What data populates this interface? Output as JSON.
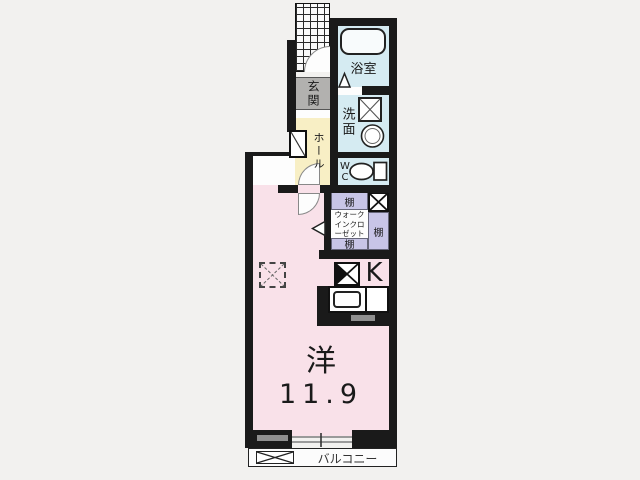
{
  "plan": {
    "type": "apartment-floor-plan",
    "rooms": {
      "entrance": {
        "label": "玄関"
      },
      "hall": {
        "label": "ホール"
      },
      "bathroom": {
        "label": "浴室"
      },
      "washroom": {
        "label": "洗面"
      },
      "toilet": {
        "label": "WC"
      },
      "walk_in_closet": {
        "label": "ウォークインクローゼット",
        "shelf_top": "棚",
        "shelf_right": "棚",
        "shelf_bottom": "棚"
      },
      "kitchen": {
        "label": "K"
      },
      "western_room": {
        "label": "洋",
        "area": "11.9"
      },
      "balcony": {
        "label": "バルコニー"
      }
    },
    "fixtures": [
      "bathtub",
      "washing-machine-pan",
      "washbasin",
      "toilet-bowl",
      "stove",
      "kitchen-sink",
      "shoe-cabinet",
      "entry-porch-grid",
      "door-swing-arc",
      "sliding-window",
      "balcony-storage-box"
    ],
    "colors": {
      "wall": "#1a1a1a",
      "western_room_fill": "#f9e1e9",
      "hall_fill": "#f8efc5",
      "entrance_fill": "#b2b1af",
      "wet_area_fill": "#d5ebf2",
      "closet_shelf_fill": "#c8c5e7",
      "balcony_fill": "#fcfcfc",
      "background": "#f2f1ef"
    }
  }
}
